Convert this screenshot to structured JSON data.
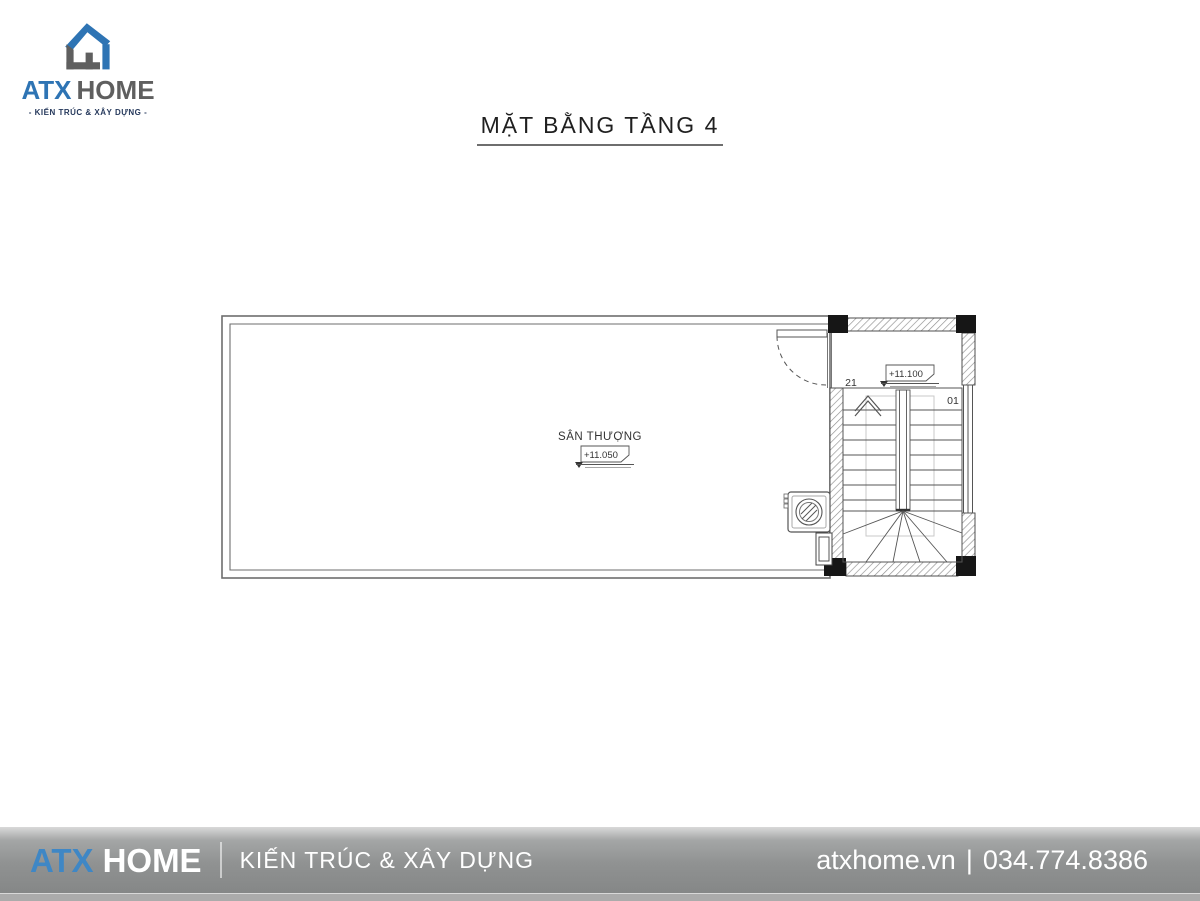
{
  "logo": {
    "brand_primary": "ATX",
    "brand_secondary": "HOME",
    "tagline": "- KIẾN TRÚC & XÂY DỰNG -"
  },
  "title": {
    "text": "MẶT BẰNG TẦNG 4"
  },
  "plan": {
    "room_label": "SÂN THƯỢNG",
    "room_level": "+11.050",
    "landing_level": "+11.100",
    "stair_step_start": "21",
    "stair_step_end": "01"
  },
  "footer": {
    "brand_primary": "ATX",
    "brand_secondary": "HOME",
    "tagline": "KIẾN TRÚC & XÂY DỰNG",
    "website": "atxhome.vn",
    "divider": "|",
    "phone": "034.774.8386"
  },
  "colors": {
    "brand_blue": "#2e74b4",
    "footer_blue": "#3f87c5",
    "logo_gray": "#5f5f5f",
    "line_gray": "#555555",
    "wall_black": "#161616"
  }
}
